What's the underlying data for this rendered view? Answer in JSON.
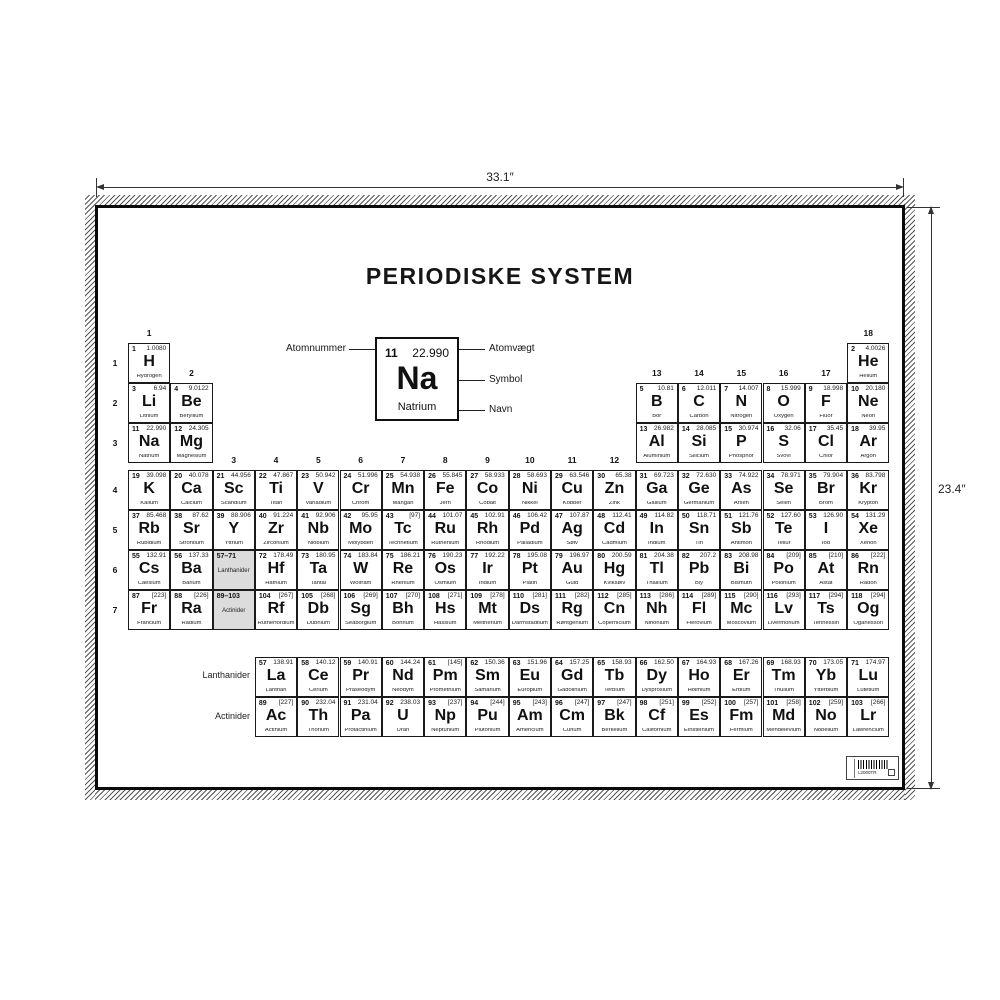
{
  "poster": {
    "title": "PERIODISKE SYSTEM",
    "dim_width": "33.1″",
    "dim_height": "23.4″",
    "legend": {
      "num": "11",
      "wt": "22.990",
      "sym": "Na",
      "name": "Natrium",
      "label_num": "Atomnummer",
      "label_wt": "Atomvægt",
      "label_sym": "Symbol",
      "label_name": "Navn"
    },
    "flabels": {
      "lanthanider": "Lanthanider",
      "actinider": "Actinider"
    },
    "period_labels": [
      "1",
      "2",
      "3",
      "4",
      "5",
      "6",
      "7"
    ],
    "group_labels": [
      {
        "label": "1",
        "col": 1,
        "tier": 1
      },
      {
        "label": "18",
        "col": 18,
        "tier": 1
      },
      {
        "label": "2",
        "col": 2,
        "tier": 2
      },
      {
        "label": "13",
        "col": 13,
        "tier": 2
      },
      {
        "label": "14",
        "col": 14,
        "tier": 2
      },
      {
        "label": "15",
        "col": 15,
        "tier": 2
      },
      {
        "label": "16",
        "col": 16,
        "tier": 2
      },
      {
        "label": "17",
        "col": 17,
        "tier": 2
      },
      {
        "label": "3",
        "col": 3,
        "tier": 3
      },
      {
        "label": "4",
        "col": 4,
        "tier": 3
      },
      {
        "label": "5",
        "col": 5,
        "tier": 3
      },
      {
        "label": "6",
        "col": 6,
        "tier": 3
      },
      {
        "label": "7",
        "col": 7,
        "tier": 3
      },
      {
        "label": "8",
        "col": 8,
        "tier": 3
      },
      {
        "label": "9",
        "col": 9,
        "tier": 3
      },
      {
        "label": "10",
        "col": 10,
        "tier": 3
      },
      {
        "label": "11",
        "col": 11,
        "tier": 3
      },
      {
        "label": "12",
        "col": 12,
        "tier": 3
      }
    ],
    "placeholders": [
      {
        "range": "57–71",
        "label": "Lanthanider",
        "p": 6,
        "g": 3
      },
      {
        "range": "89–103",
        "label": "Actinider",
        "p": 7,
        "g": 3
      }
    ],
    "elements": [
      {
        "num": "1",
        "sym": "H",
        "wt": "1.0080",
        "name": "Hydrogen",
        "p": 1,
        "g": 1
      },
      {
        "num": "2",
        "sym": "He",
        "wt": "4.0026",
        "name": "Helium",
        "p": 1,
        "g": 18
      },
      {
        "num": "3",
        "sym": "Li",
        "wt": "6.94",
        "name": "Lithium",
        "p": 2,
        "g": 1
      },
      {
        "num": "4",
        "sym": "Be",
        "wt": "9.0122",
        "name": "Beryllium",
        "p": 2,
        "g": 2
      },
      {
        "num": "5",
        "sym": "B",
        "wt": "10.81",
        "name": "Bor",
        "p": 2,
        "g": 13
      },
      {
        "num": "6",
        "sym": "C",
        "wt": "12.011",
        "name": "Carbon",
        "p": 2,
        "g": 14
      },
      {
        "num": "7",
        "sym": "N",
        "wt": "14.007",
        "name": "Nitrogen",
        "p": 2,
        "g": 15
      },
      {
        "num": "8",
        "sym": "O",
        "wt": "15.999",
        "name": "Oxygen",
        "p": 2,
        "g": 16
      },
      {
        "num": "9",
        "sym": "F",
        "wt": "18.998",
        "name": "Fluor",
        "p": 2,
        "g": 17
      },
      {
        "num": "10",
        "sym": "Ne",
        "wt": "20.180",
        "name": "Neon",
        "p": 2,
        "g": 18
      },
      {
        "num": "11",
        "sym": "Na",
        "wt": "22.990",
        "name": "Natrium",
        "p": 3,
        "g": 1
      },
      {
        "num": "12",
        "sym": "Mg",
        "wt": "24.305",
        "name": "Magnesium",
        "p": 3,
        "g": 2
      },
      {
        "num": "13",
        "sym": "Al",
        "wt": "26.982",
        "name": "Aluminium",
        "p": 3,
        "g": 13
      },
      {
        "num": "14",
        "sym": "Si",
        "wt": "28.085",
        "name": "Silicium",
        "p": 3,
        "g": 14
      },
      {
        "num": "15",
        "sym": "P",
        "wt": "30.974",
        "name": "Phosphor",
        "p": 3,
        "g": 15
      },
      {
        "num": "16",
        "sym": "S",
        "wt": "32.06",
        "name": "Svovl",
        "p": 3,
        "g": 16
      },
      {
        "num": "17",
        "sym": "Cl",
        "wt": "35.45",
        "name": "Chlor",
        "p": 3,
        "g": 17
      },
      {
        "num": "18",
        "sym": "Ar",
        "wt": "39.95",
        "name": "Argon",
        "p": 3,
        "g": 18
      },
      {
        "num": "19",
        "sym": "K",
        "wt": "39.098",
        "name": "Kalium",
        "p": 4,
        "g": 1
      },
      {
        "num": "20",
        "sym": "Ca",
        "wt": "40.078",
        "name": "Calcium",
        "p": 4,
        "g": 2
      },
      {
        "num": "21",
        "sym": "Sc",
        "wt": "44.956",
        "name": "Scandium",
        "p": 4,
        "g": 3
      },
      {
        "num": "22",
        "sym": "Ti",
        "wt": "47.867",
        "name": "Titan",
        "p": 4,
        "g": 4
      },
      {
        "num": "23",
        "sym": "V",
        "wt": "50.942",
        "name": "Vanadium",
        "p": 4,
        "g": 5
      },
      {
        "num": "24",
        "sym": "Cr",
        "wt": "51.996",
        "name": "Chrom",
        "p": 4,
        "g": 6
      },
      {
        "num": "25",
        "sym": "Mn",
        "wt": "54.938",
        "name": "Mangan",
        "p": 4,
        "g": 7
      },
      {
        "num": "26",
        "sym": "Fe",
        "wt": "55.845",
        "name": "Jern",
        "p": 4,
        "g": 8
      },
      {
        "num": "27",
        "sym": "Co",
        "wt": "58.933",
        "name": "Cobalt",
        "p": 4,
        "g": 9
      },
      {
        "num": "28",
        "sym": "Ni",
        "wt": "58.693",
        "name": "Nikkel",
        "p": 4,
        "g": 10
      },
      {
        "num": "29",
        "sym": "Cu",
        "wt": "63.546",
        "name": "Kobber",
        "p": 4,
        "g": 11
      },
      {
        "num": "30",
        "sym": "Zn",
        "wt": "65.38",
        "name": "Zink",
        "p": 4,
        "g": 12
      },
      {
        "num": "31",
        "sym": "Ga",
        "wt": "69.723",
        "name": "Gallium",
        "p": 4,
        "g": 13
      },
      {
        "num": "32",
        "sym": "Ge",
        "wt": "72.630",
        "name": "Germanium",
        "p": 4,
        "g": 14
      },
      {
        "num": "33",
        "sym": "As",
        "wt": "74.922",
        "name": "Arsen",
        "p": 4,
        "g": 15
      },
      {
        "num": "34",
        "sym": "Se",
        "wt": "78.971",
        "name": "Selen",
        "p": 4,
        "g": 16
      },
      {
        "num": "35",
        "sym": "Br",
        "wt": "79.904",
        "name": "Brom",
        "p": 4,
        "g": 17
      },
      {
        "num": "36",
        "sym": "Kr",
        "wt": "83.798",
        "name": "Krypton",
        "p": 4,
        "g": 18
      },
      {
        "num": "37",
        "sym": "Rb",
        "wt": "85.468",
        "name": "Rubidium",
        "p": 5,
        "g": 1
      },
      {
        "num": "38",
        "sym": "Sr",
        "wt": "87.62",
        "name": "Strontium",
        "p": 5,
        "g": 2
      },
      {
        "num": "39",
        "sym": "Y",
        "wt": "88.906",
        "name": "Yttrium",
        "p": 5,
        "g": 3
      },
      {
        "num": "40",
        "sym": "Zr",
        "wt": "91.224",
        "name": "Zirconium",
        "p": 5,
        "g": 4
      },
      {
        "num": "41",
        "sym": "Nb",
        "wt": "92.906",
        "name": "Niobium",
        "p": 5,
        "g": 5
      },
      {
        "num": "42",
        "sym": "Mo",
        "wt": "95.95",
        "name": "Molybden",
        "p": 5,
        "g": 6
      },
      {
        "num": "43",
        "sym": "Tc",
        "wt": "[97]",
        "name": "Technetium",
        "p": 5,
        "g": 7
      },
      {
        "num": "44",
        "sym": "Ru",
        "wt": "101.07",
        "name": "Ruthenium",
        "p": 5,
        "g": 8
      },
      {
        "num": "45",
        "sym": "Rh",
        "wt": "102.91",
        "name": "Rhodium",
        "p": 5,
        "g": 9
      },
      {
        "num": "46",
        "sym": "Pd",
        "wt": "106.42",
        "name": "Palladium",
        "p": 5,
        "g": 10
      },
      {
        "num": "47",
        "sym": "Ag",
        "wt": "107.87",
        "name": "Sølv",
        "p": 5,
        "g": 11
      },
      {
        "num": "48",
        "sym": "Cd",
        "wt": "112.41",
        "name": "Cadmium",
        "p": 5,
        "g": 12
      },
      {
        "num": "49",
        "sym": "In",
        "wt": "114.82",
        "name": "Indium",
        "p": 5,
        "g": 13
      },
      {
        "num": "50",
        "sym": "Sn",
        "wt": "118.71",
        "name": "Tin",
        "p": 5,
        "g": 14
      },
      {
        "num": "51",
        "sym": "Sb",
        "wt": "121.76",
        "name": "Antimon",
        "p": 5,
        "g": 15
      },
      {
        "num": "52",
        "sym": "Te",
        "wt": "127.60",
        "name": "Tellur",
        "p": 5,
        "g": 16
      },
      {
        "num": "53",
        "sym": "I",
        "wt": "126.90",
        "name": "Iod",
        "p": 5,
        "g": 17
      },
      {
        "num": "54",
        "sym": "Xe",
        "wt": "131.29",
        "name": "Xenon",
        "p": 5,
        "g": 18
      },
      {
        "num": "55",
        "sym": "Cs",
        "wt": "132.91",
        "name": "Caesium",
        "p": 6,
        "g": 1
      },
      {
        "num": "56",
        "sym": "Ba",
        "wt": "137.33",
        "name": "Barium",
        "p": 6,
        "g": 2
      },
      {
        "num": "72",
        "sym": "Hf",
        "wt": "178.49",
        "name": "Hafnium",
        "p": 6,
        "g": 4
      },
      {
        "num": "73",
        "sym": "Ta",
        "wt": "180.95",
        "name": "Tantal",
        "p": 6,
        "g": 5
      },
      {
        "num": "74",
        "sym": "W",
        "wt": "183.84",
        "name": "Wolfram",
        "p": 6,
        "g": 6
      },
      {
        "num": "75",
        "sym": "Re",
        "wt": "186.21",
        "name": "Rhenium",
        "p": 6,
        "g": 7
      },
      {
        "num": "76",
        "sym": "Os",
        "wt": "190.23",
        "name": "Osmium",
        "p": 6,
        "g": 8
      },
      {
        "num": "77",
        "sym": "Ir",
        "wt": "192.22",
        "name": "Iridium",
        "p": 6,
        "g": 9
      },
      {
        "num": "78",
        "sym": "Pt",
        "wt": "195.08",
        "name": "Platin",
        "p": 6,
        "g": 10
      },
      {
        "num": "79",
        "sym": "Au",
        "wt": "196.97",
        "name": "Guld",
        "p": 6,
        "g": 11
      },
      {
        "num": "80",
        "sym": "Hg",
        "wt": "200.59",
        "name": "Kviksølv",
        "p": 6,
        "g": 12
      },
      {
        "num": "81",
        "sym": "Tl",
        "wt": "204.38",
        "name": "Thallium",
        "p": 6,
        "g": 13
      },
      {
        "num": "82",
        "sym": "Pb",
        "wt": "207.2",
        "name": "Bly",
        "p": 6,
        "g": 14
      },
      {
        "num": "83",
        "sym": "Bi",
        "wt": "208.98",
        "name": "Bismuth",
        "p": 6,
        "g": 15
      },
      {
        "num": "84",
        "sym": "Po",
        "wt": "[209]",
        "name": "Polonium",
        "p": 6,
        "g": 16
      },
      {
        "num": "85",
        "sym": "At",
        "wt": "[210]",
        "name": "Astat",
        "p": 6,
        "g": 17
      },
      {
        "num": "86",
        "sym": "Rn",
        "wt": "[222]",
        "name": "Radon",
        "p": 6,
        "g": 18
      },
      {
        "num": "87",
        "sym": "Fr",
        "wt": "[223]",
        "name": "Francium",
        "p": 7,
        "g": 1
      },
      {
        "num": "88",
        "sym": "Ra",
        "wt": "[226]",
        "name": "Radium",
        "p": 7,
        "g": 2
      },
      {
        "num": "104",
        "sym": "Rf",
        "wt": "[267]",
        "name": "Rutherfordium",
        "p": 7,
        "g": 4
      },
      {
        "num": "105",
        "sym": "Db",
        "wt": "[268]",
        "name": "Dubnium",
        "p": 7,
        "g": 5
      },
      {
        "num": "106",
        "sym": "Sg",
        "wt": "[269]",
        "name": "Seaborgium",
        "p": 7,
        "g": 6
      },
      {
        "num": "107",
        "sym": "Bh",
        "wt": "[270]",
        "name": "Bohrium",
        "p": 7,
        "g": 7
      },
      {
        "num": "108",
        "sym": "Hs",
        "wt": "[271]",
        "name": "Hassium",
        "p": 7,
        "g": 8
      },
      {
        "num": "109",
        "sym": "Mt",
        "wt": "[278]",
        "name": "Meitnerium",
        "p": 7,
        "g": 9
      },
      {
        "num": "110",
        "sym": "Ds",
        "wt": "[281]",
        "name": "Darmstadtium",
        "p": 7,
        "g": 10
      },
      {
        "num": "111",
        "sym": "Rg",
        "wt": "[282]",
        "name": "Røntgenium",
        "p": 7,
        "g": 11
      },
      {
        "num": "112",
        "sym": "Cn",
        "wt": "[285]",
        "name": "Copernicium",
        "p": 7,
        "g": 12
      },
      {
        "num": "113",
        "sym": "Nh",
        "wt": "[286]",
        "name": "Nihonium",
        "p": 7,
        "g": 13
      },
      {
        "num": "114",
        "sym": "Fl",
        "wt": "[289]",
        "name": "Flerovium",
        "p": 7,
        "g": 14
      },
      {
        "num": "115",
        "sym": "Mc",
        "wt": "[290]",
        "name": "Moscovium",
        "p": 7,
        "g": 15
      },
      {
        "num": "116",
        "sym": "Lv",
        "wt": "[293]",
        "name": "Livermorium",
        "p": 7,
        "g": 16
      },
      {
        "num": "117",
        "sym": "Ts",
        "wt": "[294]",
        "name": "Tennessin",
        "p": 7,
        "g": 17
      },
      {
        "num": "118",
        "sym": "Og",
        "wt": "[294]",
        "name": "Oganesson",
        "p": 7,
        "g": 18
      }
    ],
    "lanthanides": [
      {
        "num": "57",
        "sym": "La",
        "wt": "138.91",
        "name": "Lanthan"
      },
      {
        "num": "58",
        "sym": "Ce",
        "wt": "140.12",
        "name": "Cerium"
      },
      {
        "num": "59",
        "sym": "Pr",
        "wt": "140.91",
        "name": "Praseodym"
      },
      {
        "num": "60",
        "sym": "Nd",
        "wt": "144.24",
        "name": "Neodym"
      },
      {
        "num": "61",
        "sym": "Pm",
        "wt": "[145]",
        "name": "Promethium"
      },
      {
        "num": "62",
        "sym": "Sm",
        "wt": "150.36",
        "name": "Samarium"
      },
      {
        "num": "63",
        "sym": "Eu",
        "wt": "151.96",
        "name": "Europium"
      },
      {
        "num": "64",
        "sym": "Gd",
        "wt": "157.25",
        "name": "Gadolinium"
      },
      {
        "num": "65",
        "sym": "Tb",
        "wt": "158.93",
        "name": "Terbium"
      },
      {
        "num": "66",
        "sym": "Dy",
        "wt": "162.50",
        "name": "Dysprosium"
      },
      {
        "num": "67",
        "sym": "Ho",
        "wt": "164.93",
        "name": "Holmium"
      },
      {
        "num": "68",
        "sym": "Er",
        "wt": "167.26",
        "name": "Erbium"
      },
      {
        "num": "69",
        "sym": "Tm",
        "wt": "168.93",
        "name": "Thulium"
      },
      {
        "num": "70",
        "sym": "Yb",
        "wt": "173.05",
        "name": "Ytterbium"
      },
      {
        "num": "71",
        "sym": "Lu",
        "wt": "174.97",
        "name": "Lutetium"
      }
    ],
    "actinides": [
      {
        "num": "89",
        "sym": "Ac",
        "wt": "[227]",
        "name": "Actinium"
      },
      {
        "num": "90",
        "sym": "Th",
        "wt": "232.04",
        "name": "Thorium"
      },
      {
        "num": "91",
        "sym": "Pa",
        "wt": "231.04",
        "name": "Protactinium"
      },
      {
        "num": "92",
        "sym": "U",
        "wt": "238.03",
        "name": "Uran"
      },
      {
        "num": "93",
        "sym": "Np",
        "wt": "[237]",
        "name": "Neptunium"
      },
      {
        "num": "94",
        "sym": "Pu",
        "wt": "[244]",
        "name": "Plutonium"
      },
      {
        "num": "95",
        "sym": "Am",
        "wt": "[243]",
        "name": "Americium"
      },
      {
        "num": "96",
        "sym": "Cm",
        "wt": "[247]",
        "name": "Curium"
      },
      {
        "num": "97",
        "sym": "Bk",
        "wt": "[247]",
        "name": "Berkelium"
      },
      {
        "num": "98",
        "sym": "Cf",
        "wt": "[251]",
        "name": "Californium"
      },
      {
        "num": "99",
        "sym": "Es",
        "wt": "[252]",
        "name": "Einsteinium"
      },
      {
        "num": "100",
        "sym": "Fm",
        "wt": "[257]",
        "name": "Fermium"
      },
      {
        "num": "101",
        "sym": "Md",
        "wt": "[258]",
        "name": "Mendelevium"
      },
      {
        "num": "102",
        "sym": "No",
        "wt": "[259]",
        "name": "Nobelium"
      },
      {
        "num": "103",
        "sym": "Lr",
        "wt": "[266]",
        "name": "Lawrencium"
      }
    ],
    "barcode": {
      "code": "L2000TR"
    }
  }
}
